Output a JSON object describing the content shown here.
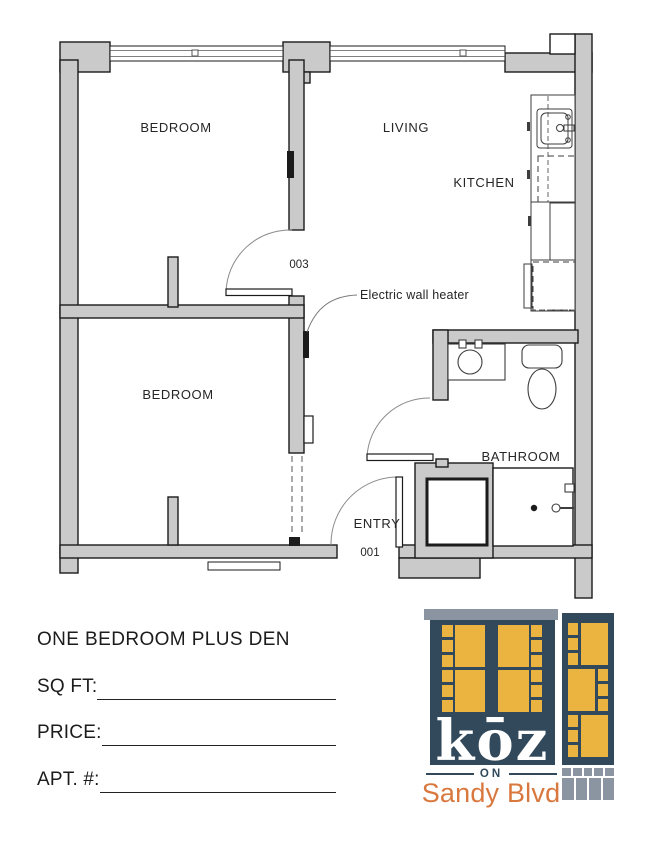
{
  "plan": {
    "room_labels": {
      "bedroom_top": "BEDROOM",
      "living": "LIVING",
      "kitchen": "KITCHEN",
      "bedroom_bottom": "BEDROOM",
      "bathroom": "BATHROOM",
      "entry": "ENTRY"
    },
    "door_numbers": {
      "bedroom_door": "003",
      "entry_door": "001"
    },
    "annotations": {
      "wall_heater": "Electric wall heater"
    }
  },
  "info": {
    "title": "ONE BEDROOM PLUS DEN",
    "fields": [
      {
        "label": "SQ FT:",
        "value": ""
      },
      {
        "label": "PRICE:",
        "value": ""
      },
      {
        "label": "APT. #:",
        "value": ""
      }
    ]
  },
  "logo": {
    "brand": "kōz",
    "divider_text": "ON",
    "location": "Sandy Blvd",
    "colors": {
      "navy": "#32495B",
      "yellow": "#EBB440",
      "gray": "#8A95A1",
      "orange": "#D9783E"
    }
  }
}
